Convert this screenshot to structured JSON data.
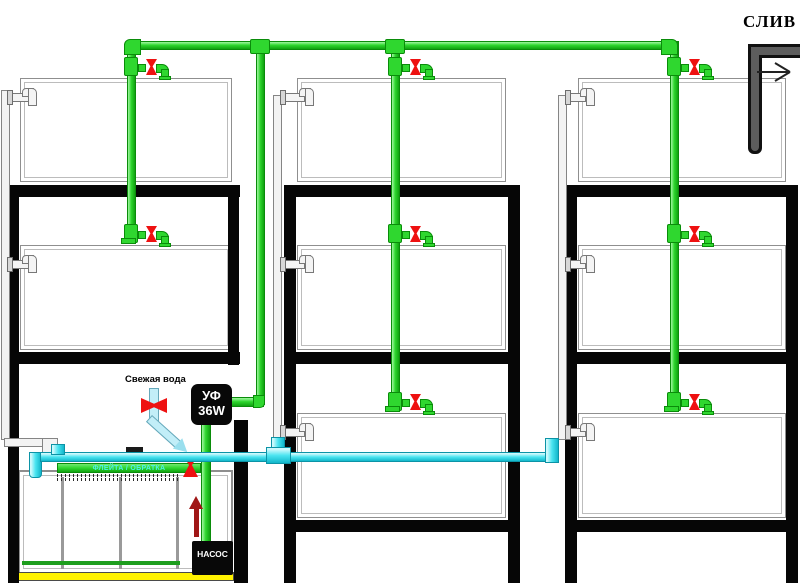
{
  "labels": {
    "drain": "СЛИВ",
    "fresh_water": "Свежая вода",
    "uv_unit_line1": "УФ",
    "uv_unit_line2": "36W",
    "pump": "НАСОС",
    "spray_bar": "ФЛЕЙТА / ОБРАТКА"
  },
  "colors": {
    "supply_pipe_green": "#2fd72f",
    "return_pipe_cyan": "#4ae4f0",
    "valve_red": "#ee1111",
    "flow_arrow_dark_red": "#a01616",
    "rack_frame_black": "#060606",
    "drain_pipe_gray": "#5d5d5d",
    "overflow_pipe_light_gray": "#f4f4f4",
    "mat_yellow": "#fff200"
  }
}
